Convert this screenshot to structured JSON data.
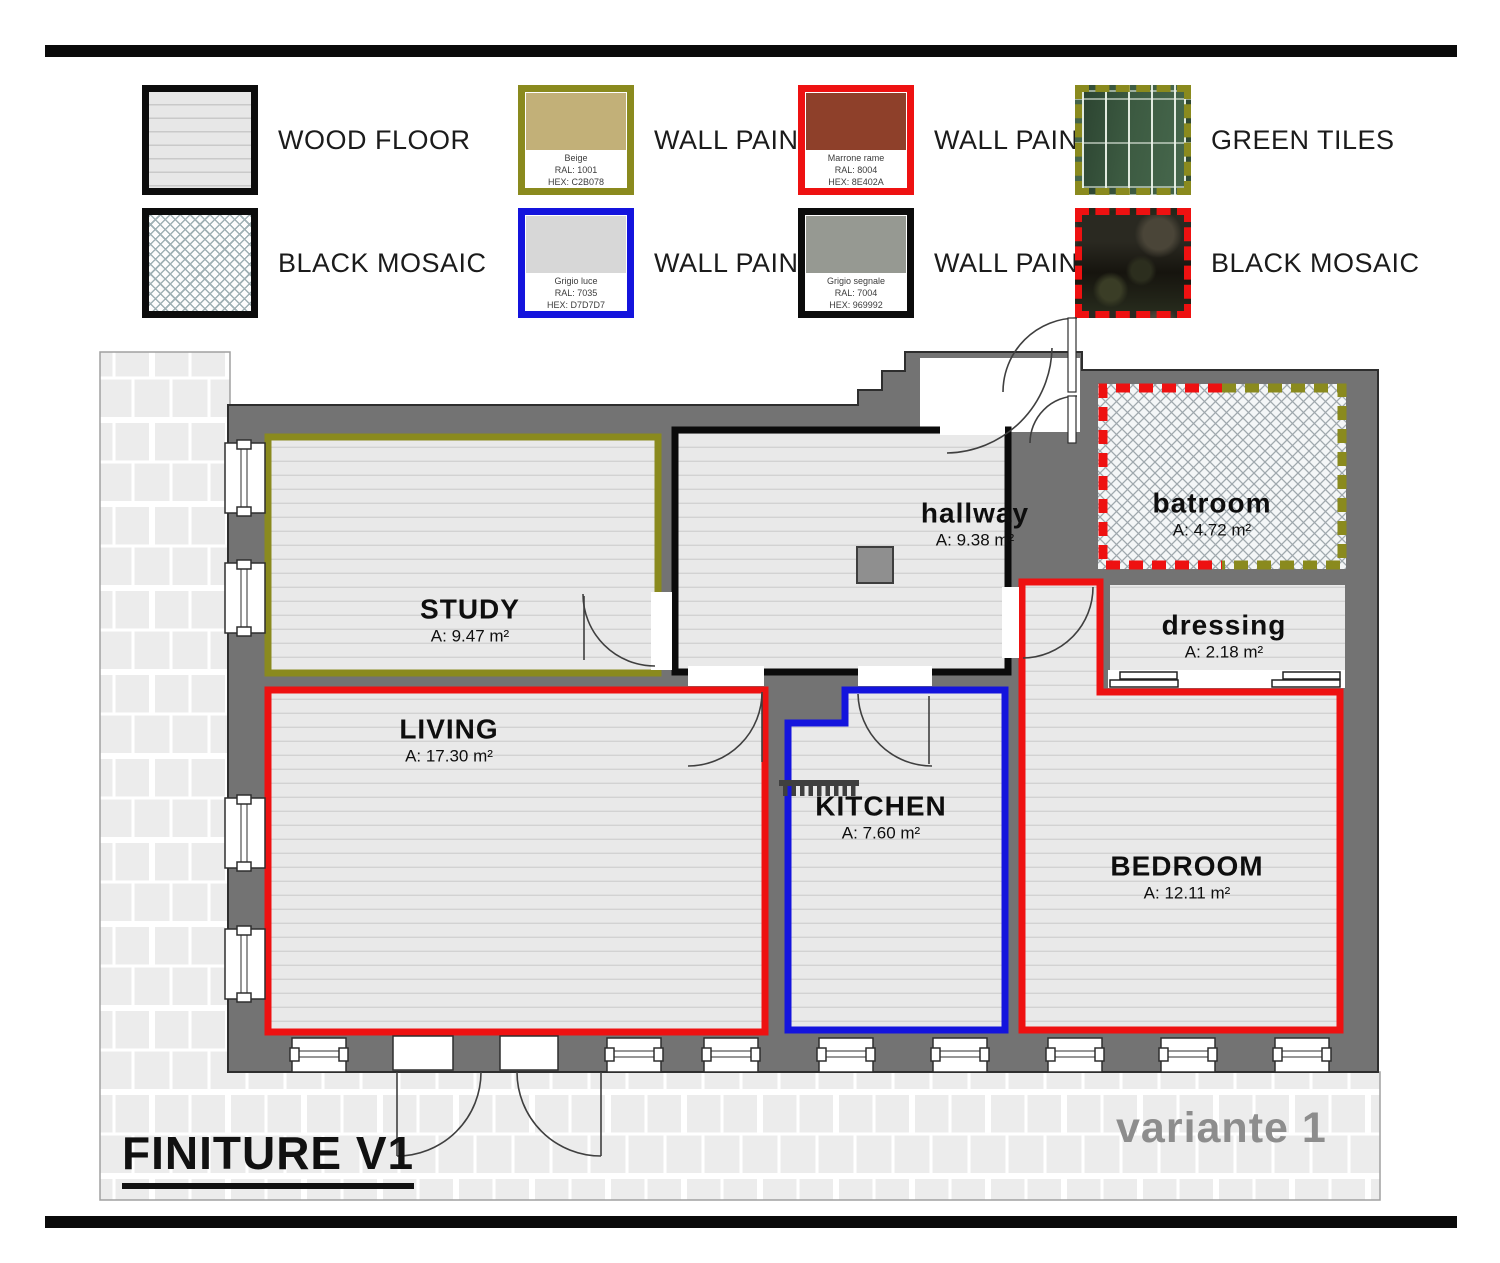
{
  "title": {
    "drawing": "FINITURE V1",
    "variant": "variante 1"
  },
  "legend": {
    "wood_floor": {
      "label": "WOOD FLOOR"
    },
    "black_mosaic": {
      "label": "BLACK MOSAIC"
    },
    "green_tiles": {
      "label": "GREEN TILES"
    },
    "black_mosaic_photo": {
      "label": "BLACK MOSAIC"
    },
    "paints": [
      {
        "label": "WALL PAINT",
        "name": "Beige",
        "ral": "RAL: 1001",
        "hex": "HEX: C2B078",
        "color": "#C2B078",
        "border_color": "#8a8a1e"
      },
      {
        "label": "WALL PAINT",
        "name": "Grigio luce",
        "ral": "RAL: 7035",
        "hex": "HEX: D7D7D7",
        "color": "#D7D7D7",
        "border_color": "#1414dd"
      },
      {
        "label": "WALL PAINT",
        "name": "Marrone rame",
        "ral": "RAL: 8004",
        "hex": "HEX: 8E402A",
        "color": "#8E402A",
        "border_color": "#ee1111"
      },
      {
        "label": "WALL PAINT",
        "name": "Grigio segnale",
        "ral": "RAL: 7004",
        "hex": "HEX: 969992",
        "color": "#969992",
        "border_color": "#0c0c0c"
      }
    ]
  },
  "rooms": {
    "study": {
      "name": "STUDY",
      "area": "A: 9.47 m²",
      "outline_color": "#8a8a1e"
    },
    "hallway": {
      "name": "hallway",
      "area": "A: 9.38 m²",
      "outline_color": "#0b0b0b"
    },
    "bathroom": {
      "name": "batroom",
      "area": "A: 4.72 m²",
      "outline_color": "#ee1111 + #8a8a1e dashed"
    },
    "dressing": {
      "name": "dressing",
      "area": "A: 2.18 m²",
      "outline_color": "none"
    },
    "living": {
      "name": "LIVING",
      "area": "A: 17.30 m²",
      "outline_color": "#ee1111"
    },
    "kitchen": {
      "name": "KITCHEN",
      "area": "A: 7.60 m²",
      "outline_color": "#1414dd"
    },
    "bedroom": {
      "name": "BEDROOM",
      "area": "A: 12.11 m²",
      "outline_color": "#ee1111"
    }
  }
}
